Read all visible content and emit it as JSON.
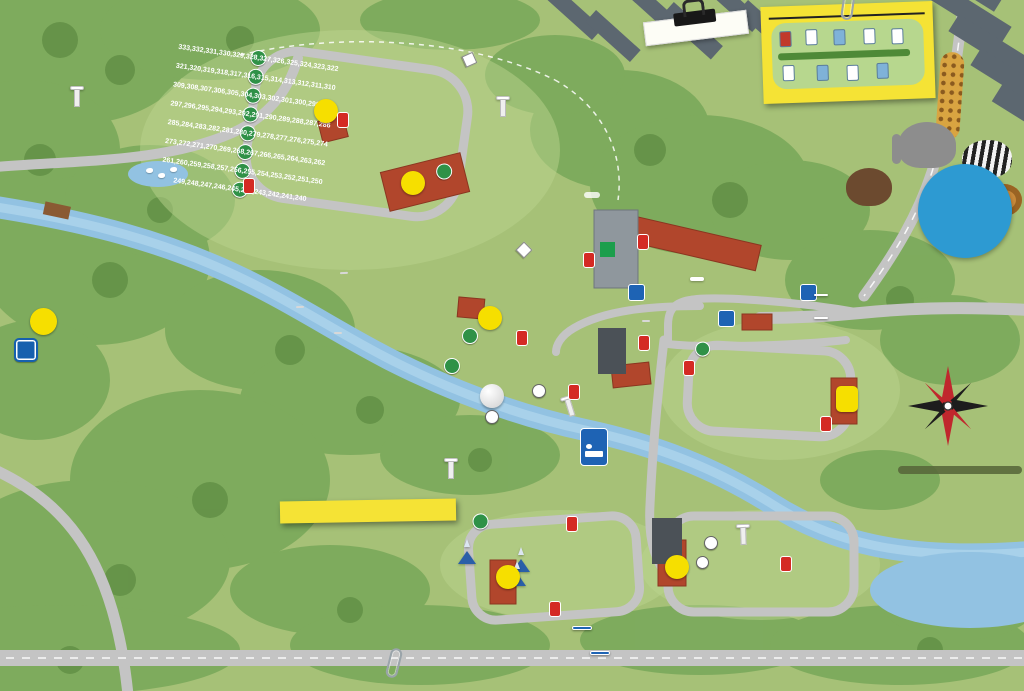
{
  "title_note": {
    "label": "Din Tomt/Stuga:"
  },
  "husvagn": {
    "title": "Husvagnsplacering",
    "gap": "4 m",
    "note": "Dragkrok ALLTID mot vägen."
  },
  "distance_bubble": {
    "lines": [
      "500 m till",
      "Borås djurpark",
      "och shopping",
      "i Knalleland"
    ]
  },
  "gps": {
    "label": "GPS koordinater",
    "coords": "57° 44'19,25  12° 55'55,51"
  },
  "signs": {
    "trollstigen": "Trollstigen",
    "bjornstugor": "Björnstugor",
    "zebrastugor": "Zebrastugor",
    "elefantstugor": "Elefantstugor",
    "taltomrade": "Tältområde",
    "lejonstugor": "Lejonstugor",
    "lillstugan": "Lillstugan",
    "vandrarhem": "Vandrarhem",
    "incheckning": "INCHECKNING",
    "infart": "Infart",
    "utfart": "Utfart",
    "infart_arrow": "←",
    "utfart_arrow": "→",
    "lekpark": "Lekpark",
    "miljohus": "Miljöhus",
    "giraffgatan": "Giraffgatan",
    "himlavalvet": "Himlavalvet",
    "viskan": "VISKAN",
    "aventyrsomradet": "Äventyrsområdet",
    "aventyrsgolf": "Äventyrsgolf",
    "aventyrskiosken": "Äventyrskiosken",
    "safaribanan": "Safaribanan",
    "start_frisbeegolf_lines": [
      "Start",
      "Frisbeegolf"
    ],
    "safarihuset_lines": [
      "Safarihuset",
      "Restaurangsafari",
      "Butik",
      "Reception"
    ],
    "almenas": "Almenäs badstrand 3 km",
    "almenas_arrow": "←",
    "rya": "Rya åsar vandring",
    "rya_arrow": "↓",
    "p": "P",
    "info": "i"
  },
  "activity_note": {
    "title": "Äventyrsområdet",
    "items": [
      "Kanoter",
      "Badplats",
      "Frisbeegolf",
      "Äventyrsgolf",
      "Äventyrskiosken",
      "Grillplats",
      "Boule",
      "Utegym",
      "Hinderbana",
      "Lekplats",
      "Bilbana"
    ]
  },
  "map_s": {
    "s1": "S1",
    "s2": "S2",
    "s3": "S3",
    "s4": "S4",
    "s5": "S5",
    "s6": "S6"
  },
  "service_blocks": [
    {
      "id": "S1",
      "rows": [
        [
          "wc",
          "shower",
          "accessible"
        ],
        [
          "motorhome",
          "freezer",
          "dishwash"
        ],
        [
          "microwave",
          "oven",
          "laundry"
        ]
      ]
    },
    {
      "id": "S2",
      "rows": [
        [
          "wc",
          "shower",
          "accessible"
        ],
        [
          "motorhome",
          "oven",
          "dishwash"
        ],
        [
          "laundry"
        ]
      ]
    },
    {
      "id": "S3",
      "rows": [
        [
          "wc",
          "shower",
          "accessible"
        ],
        [
          "motorhome",
          "freezer",
          "dishwash"
        ],
        [
          "microwave",
          "oven",
          "laundry"
        ],
        [
          "baby"
        ]
      ]
    },
    {
      "id": "S4",
      "rows": [
        [
          "wc",
          "shower"
        ],
        [
          "dishwash"
        ]
      ]
    },
    {
      "id": "S5",
      "rows": [
        [
          "wc",
          "shower",
          "accessible"
        ],
        [
          "motorhome",
          "oven",
          "dishwash"
        ],
        [
          "laundry"
        ]
      ]
    },
    {
      "id": "S6",
      "rows": [
        [
          "wc",
          "shower",
          "accessible"
        ],
        [
          "motorhome",
          "oven",
          "dishwash"
        ],
        [
          "laundry"
        ]
      ]
    }
  ],
  "camp": {
    "main_rows": [
      [
        345,
        344,
        343,
        342,
        341,
        340,
        339,
        338,
        337,
        336,
        335,
        334
      ],
      [
        333,
        332,
        331,
        330,
        329,
        328,
        327,
        326,
        325,
        324,
        323,
        322
      ],
      [
        321,
        320,
        319,
        318,
        317,
        316,
        315,
        314,
        313,
        312,
        311,
        310
      ],
      [
        309,
        308,
        307,
        306,
        305,
        304,
        303,
        302,
        301,
        300,
        299,
        298
      ],
      [
        297,
        296,
        295,
        294,
        293,
        292,
        291,
        290,
        289,
        288,
        287,
        286
      ],
      [
        285,
        284,
        283,
        282,
        281,
        280,
        279,
        278,
        277,
        276,
        275,
        274
      ],
      [
        273,
        272,
        271,
        270,
        269,
        268,
        267,
        266,
        265,
        264,
        263,
        262
      ],
      [
        261,
        260,
        259,
        258,
        257,
        256,
        255,
        254,
        253,
        252,
        251,
        250
      ],
      [
        249,
        248,
        247,
        246,
        245,
        244,
        243,
        242,
        241,
        240
      ]
    ],
    "strip_rows": [
      [
        239,
        238,
        237,
        236,
        235,
        234,
        233,
        232
      ],
      [
        231,
        230,
        229,
        228,
        227,
        226,
        225,
        224
      ],
      [
        223,
        222,
        221,
        220,
        219,
        218,
        217,
        216
      ],
      [
        215,
        214,
        213,
        212,
        211,
        210,
        209,
        208
      ],
      [
        207,
        206,
        205,
        204,
        203,
        202,
        201,
        200
      ],
      [
        199,
        198,
        197,
        196,
        195,
        194,
        193,
        192
      ],
      [
        191,
        190,
        189,
        188,
        187,
        186,
        185,
        184
      ],
      [
        183,
        182,
        181,
        180,
        179,
        178,
        177,
        176
      ],
      [
        175,
        174,
        173,
        172,
        171,
        170,
        169,
        168
      ]
    ],
    "right_rows": [
      [
        70,
        69,
        68,
        67,
        66,
        65,
        64,
        63,
        62,
        61,
        60,
        59
      ],
      [
        80,
        79,
        78,
        77,
        76,
        75,
        74,
        73,
        72,
        71
      ],
      [
        90,
        89,
        88,
        87,
        86,
        85,
        84,
        83,
        82,
        81
      ],
      [
        101,
        100,
        99,
        98,
        97,
        96,
        95,
        94,
        93,
        92,
        91
      ]
    ],
    "bottom_rows": [
      [
        427,
        426,
        415,
        414,
        403,
        402
      ],
      [
        428,
        425,
        416,
        413,
        404,
        401
      ],
      [
        429,
        424,
        417,
        412,
        405,
        400
      ],
      [
        430,
        423,
        418,
        411,
        406,
        399
      ],
      [
        431,
        422,
        419,
        410,
        407,
        398
      ],
      [
        432,
        421,
        420,
        409,
        408,
        397
      ]
    ],
    "giraff_row1": [
      505,
      504,
      503,
      502,
      501,
      500
    ],
    "giraff_row2": [
      515,
      514,
      513,
      512,
      511,
      510,
      509,
      508,
      507,
      506
    ],
    "himla": [
      3,
      1
    ],
    "zebra_rows": [
      [
        28,
        27
      ],
      [
        30,
        29
      ]
    ],
    "lejon_cols": [
      [
        26,
        25,
        24,
        23,
        22,
        21,
        20
      ],
      [
        19,
        18,
        17
      ]
    ],
    "bjorn": [
      42,
      41,
      40,
      39,
      38,
      37,
      36,
      35,
      34,
      33,
      32,
      31
    ],
    "elefant_houses": [
      1,
      2,
      3,
      4,
      5,
      6
    ],
    "elefant_clusters": [
      {
        "rows": [
          [
            43,
            44,
            45,
            46
          ],
          [
            55,
            56,
            57,
            58
          ]
        ]
      },
      {
        "rows": [
          [
            47,
            48,
            49,
            50
          ],
          [
            59,
            60,
            61,
            62
          ]
        ]
      },
      {
        "rows": [
          [
            51,
            52,
            53,
            54
          ],
          [
            63,
            64,
            65,
            66
          ]
        ]
      }
    ]
  }
}
